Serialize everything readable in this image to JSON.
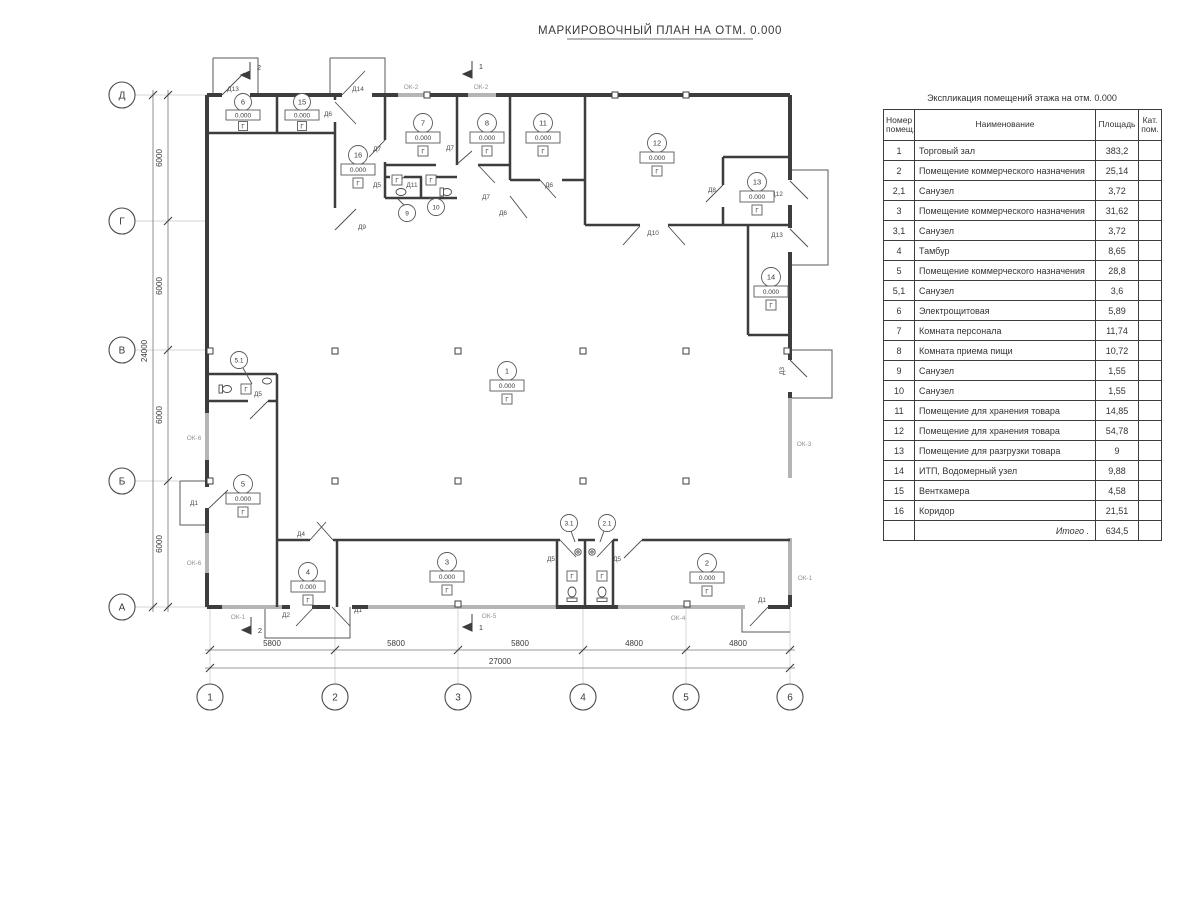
{
  "title": "МАРКИРОВОЧНЫЙ ПЛАН НА ОТМ. 0.000",
  "plan": {
    "elevation": "0.000",
    "floor_mark": "Г",
    "room_markers": [
      "1",
      "2",
      "3",
      "4",
      "5",
      "6",
      "7",
      "8",
      "11",
      "12",
      "13",
      "14",
      "15",
      "16"
    ],
    "leader_markers": [
      "5.1",
      "3.1",
      "2.1",
      "9",
      "10"
    ],
    "door_labels": [
      "Д13",
      "Д14",
      "Д6",
      "Д7",
      "Д7",
      "Д5",
      "Д11",
      "Д7",
      "Д6",
      "Д6",
      "Д9",
      "Д8",
      "Д10",
      "Д12",
      "Д13",
      "Д3",
      "Д1",
      "Д5",
      "Д4",
      "Д2",
      "Д1",
      "Д5",
      "Д5",
      "Д1"
    ],
    "window_labels": [
      "ОК-2",
      "ОК-2",
      "ОК-6",
      "ОК-6",
      "ОК-1",
      "ОК-5",
      "ОК-4",
      "ОК-1",
      "ОК-3"
    ],
    "section_marks": [
      "2",
      "1",
      "2",
      "1"
    ]
  },
  "axes": {
    "rows": [
      "Д",
      "Г",
      "В",
      "Б",
      "А"
    ],
    "cols": [
      "1",
      "2",
      "3",
      "4",
      "5",
      "6"
    ]
  },
  "dimensions": {
    "left_segments": [
      "6000",
      "6000",
      "6000",
      "6000"
    ],
    "left_total": "24000",
    "bottom_segments": [
      "5800",
      "5800",
      "5800",
      "4800",
      "4800"
    ],
    "bottom_total": "27000"
  },
  "table": {
    "title": "Экспликация помещений этажа на отм. 0.000",
    "headers": {
      "num": "Номер помещ.",
      "name": "Наименование",
      "area": "Площадь",
      "cat": "Кат. пом."
    },
    "rows": [
      {
        "num": "1",
        "name": "Торговый зал",
        "area": "383,2"
      },
      {
        "num": "2",
        "name": "Помещение коммерческого назначения",
        "area": "25,14"
      },
      {
        "num": "2,1",
        "name": "Санузел",
        "area": "3,72"
      },
      {
        "num": "3",
        "name": "Помещение коммерческого назначения",
        "area": "31,62"
      },
      {
        "num": "3,1",
        "name": "Санузел",
        "area": "3,72"
      },
      {
        "num": "4",
        "name": "Тамбур",
        "area": "8,65"
      },
      {
        "num": "5",
        "name": "Помещение коммерческого назначения",
        "area": "28,8"
      },
      {
        "num": "5,1",
        "name": "Санузел",
        "area": "3,6"
      },
      {
        "num": "6",
        "name": "Электрощитовая",
        "area": "5,89"
      },
      {
        "num": "7",
        "name": "Комната персонала",
        "area": "11,74"
      },
      {
        "num": "8",
        "name": "Комната приема пищи",
        "area": "10,72"
      },
      {
        "num": "9",
        "name": "Санузел",
        "area": "1,55"
      },
      {
        "num": "10",
        "name": "Санузел",
        "area": "1,55"
      },
      {
        "num": "11",
        "name": "Помещение для хранения товара",
        "area": "14,85"
      },
      {
        "num": "12",
        "name": "Помещение для хранения товара",
        "area": "54,78"
      },
      {
        "num": "13",
        "name": "Помещение для разгрузки товара",
        "area": "9"
      },
      {
        "num": "14",
        "name": "ИТП, Водомерный узел",
        "area": "9,88"
      },
      {
        "num": "15",
        "name": "Венткамера",
        "area": "4,58"
      },
      {
        "num": "16",
        "name": "Коридор",
        "area": "21,51"
      }
    ],
    "total_label": "Итого .",
    "total_value": "634,5"
  }
}
